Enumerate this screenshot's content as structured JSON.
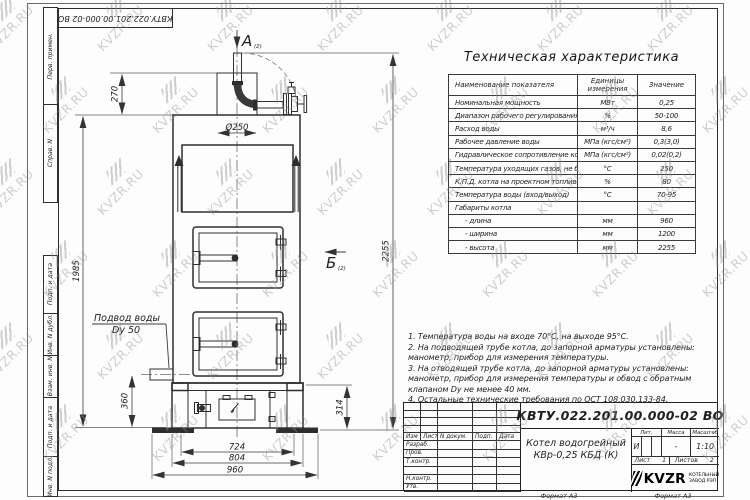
{
  "watermark": {
    "text": "KVZR.RU"
  },
  "frame": {
    "doc_number_top": "КВТУ.022.201.00.000-02  ВО",
    "margin_top": [
      {
        "label": "Перв. примен."
      },
      {
        "label": "Справ. N"
      }
    ],
    "margin_bottom": [
      {
        "label": "Подп. и дата"
      },
      {
        "label": "Инв. N дубл."
      },
      {
        "label": "Взам. инв. N"
      },
      {
        "label": "Подп. и дата"
      },
      {
        "label": "Инв. N подл."
      }
    ],
    "format_labels": [
      "Формат А3",
      "Формат А3"
    ]
  },
  "table": {
    "title": "Техническая характеристика",
    "headers": [
      "Наименование показателя",
      "Единицы измерения",
      "Значение"
    ],
    "rows": [
      {
        "name": "Номинальная мощность",
        "unit": "МВт",
        "value": "0,25",
        "indent": false
      },
      {
        "name": "Диапазон рабочего регулирования",
        "unit": "%",
        "value": "50-100",
        "indent": false
      },
      {
        "name": "Расход воды",
        "unit": "м³/ч",
        "value": "8,6",
        "indent": false
      },
      {
        "name": "Рабочее давление воды",
        "unit": "МПа (кгс/см²)",
        "value": "0,3(3,0)",
        "indent": false
      },
      {
        "name": "Гидравлическое сопротивление котла",
        "unit": "МПа (кгс/см²)",
        "value": "0,02(0,2)",
        "indent": false
      },
      {
        "name": "Температура уходящих газов, не более",
        "unit": "°С",
        "value": "250",
        "indent": false
      },
      {
        "name": "К.П.Д. котла на проектном топливе",
        "unit": "%",
        "value": "80",
        "indent": false
      },
      {
        "name": "Температура воды (вход/выход)",
        "unit": "°С",
        "value": "70-95",
        "indent": false
      },
      {
        "name": "Габариты котла",
        "unit": "",
        "value": "",
        "indent": false
      },
      {
        "name": "- длина",
        "unit": "мм",
        "value": "960",
        "indent": true
      },
      {
        "name": "- ширина",
        "unit": "мм",
        "value": "1200",
        "indent": true
      },
      {
        "name": "- высота",
        "unit": "мм",
        "value": "2255",
        "indent": true
      }
    ]
  },
  "notes": [
    "1.  Температура воды на входе  70°С, на выходе  95°С.",
    "2.  На подводящей трубе котла, до запорной арматуры установлены: манометр, прибор для измерения температуры.",
    "3.  На отводящей трубе котла, до запорной арматуры установлены: манометр, прибор для измерения температуры и обвод с обратным клапаном  Dу не менее 40 мм.",
    "4.  Остальные технические требования по ОСТ  108.030.133-84."
  ],
  "drawing": {
    "view_a": "А",
    "view_a_ref": "(2)",
    "view_b": "Б",
    "view_b_ref": "(2)",
    "water_label_1": "Подвод воды",
    "water_label_2": "Dy 50",
    "dims": {
      "d270": "270",
      "d250": "Ø250",
      "d1985": "1985",
      "d2255": "2255",
      "d360": "360",
      "d314": "314",
      "d724": "724",
      "d804": "804",
      "d960": "960"
    }
  },
  "title_block": {
    "doc_number": "КВТУ.022.201.00.000-02  ВО",
    "product_name_line1": "Котел водогрейный",
    "product_name_line2": "КВр-0,25  КБД  (К)",
    "rev_headers": [
      "Изм",
      "Лист",
      "N докум.",
      "Подп.",
      "Дата"
    ],
    "sign_rows": [
      "Разраб.",
      "Пров.",
      "Т.контр.",
      "",
      "Н.контр.",
      "Утв."
    ],
    "lit_header": "Лит.",
    "mass_header": "Масса",
    "scale_header": "Масштаб",
    "lit_value": "И",
    "mass_value": "-",
    "scale_value": "1:10",
    "sheet_label": "Лист",
    "sheet_value": "1",
    "sheets_label": "Листов",
    "sheets_value": "2",
    "logo_text": "KVZR",
    "company_line1": "КОТЕЛЬНЫЙ",
    "company_line2": "ЗАВОД РЭП"
  }
}
